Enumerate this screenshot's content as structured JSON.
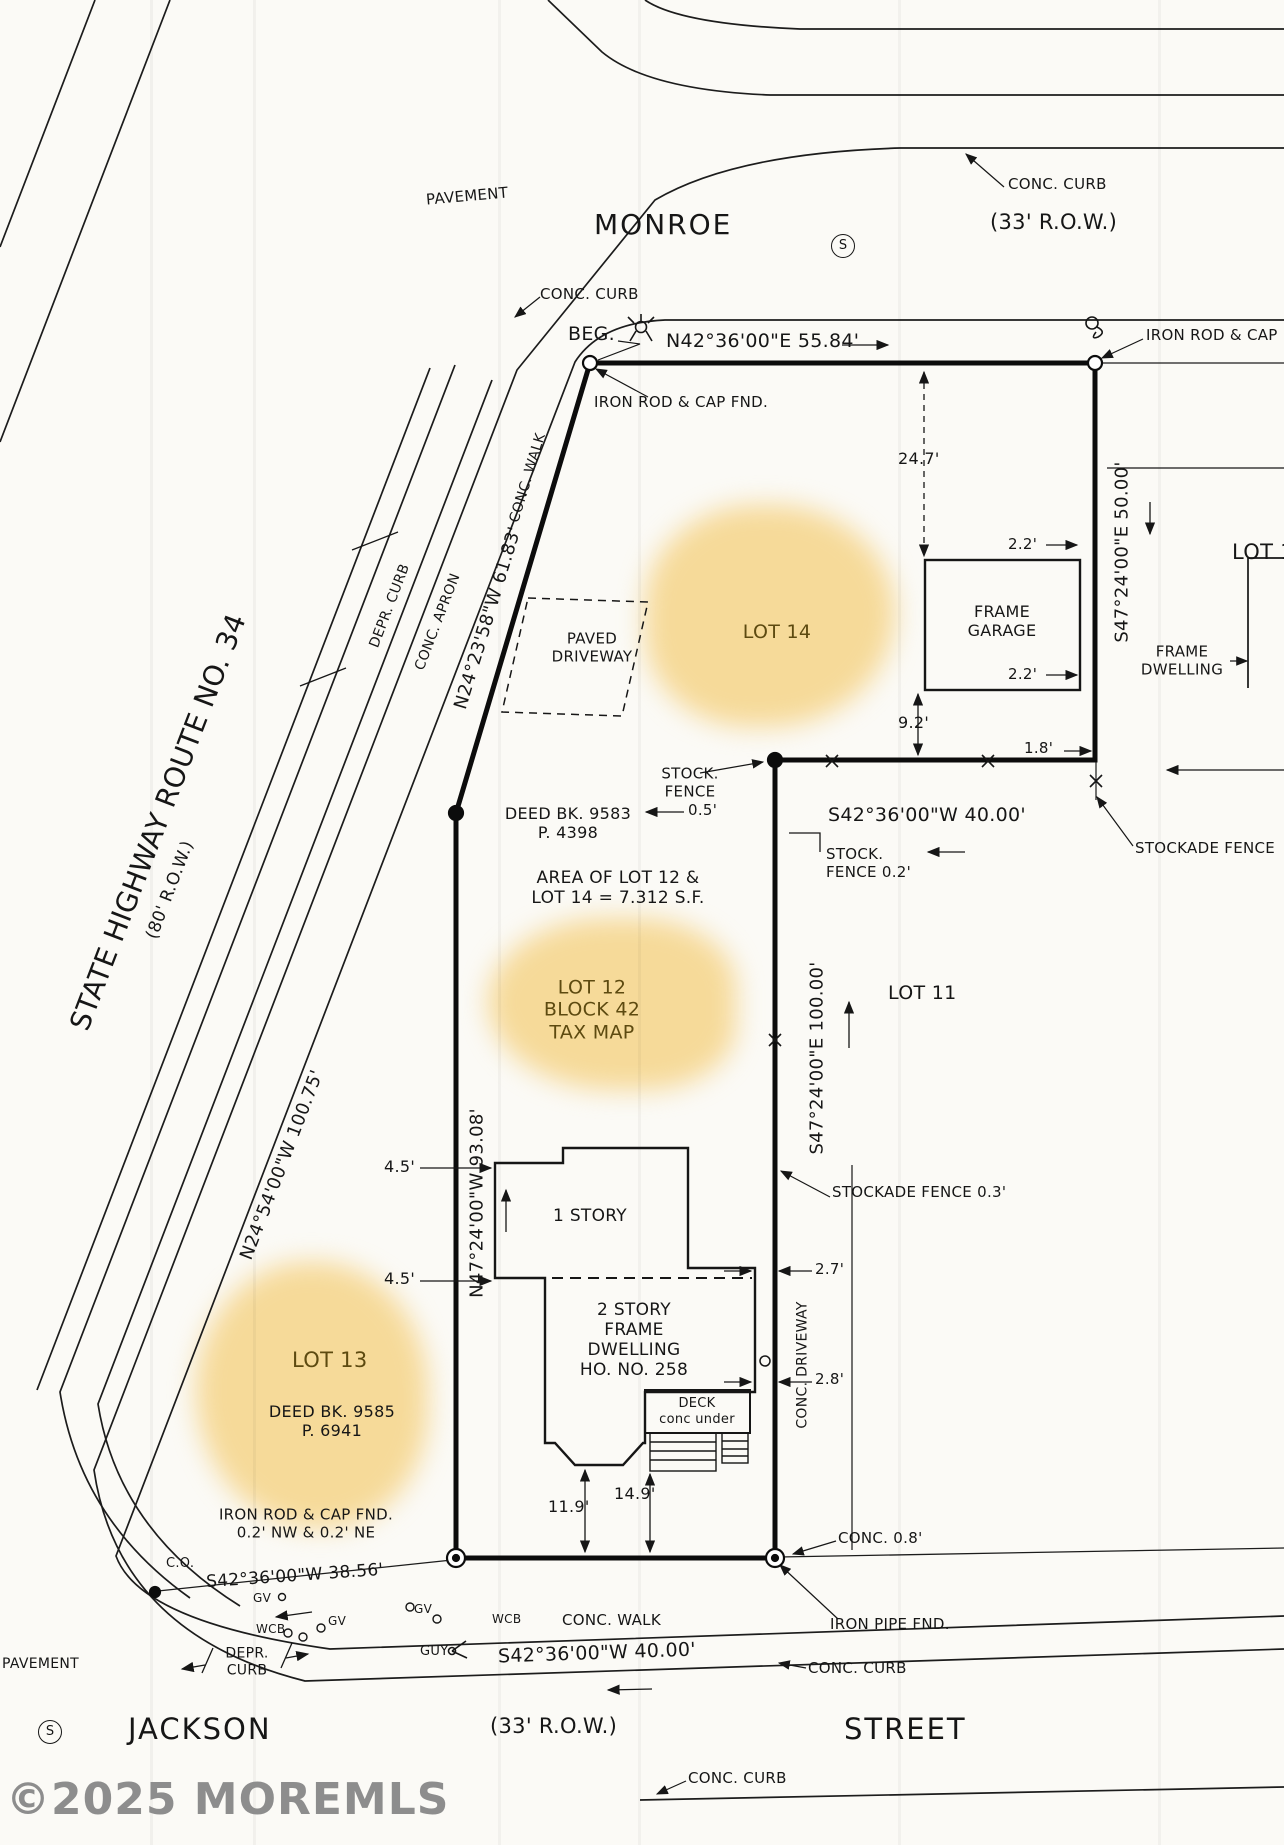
{
  "watermark": "©2025 MOREMLS",
  "streets": {
    "monroe": "MONROE",
    "monroe_row": "(33' R.O.W.)",
    "jackson": "JACKSON",
    "jackson_row": "(33' R.O.W.)",
    "street": "STREET",
    "highway_name": "STATE  HIGHWAY  ROUTE  NO. 34",
    "highway_row": "(80' R.O.W.)",
    "pavement_top": "PAVEMENT",
    "pavement_bottom": "PAVEMENT",
    "s_symbol": "S"
  },
  "bearings": {
    "top": "N42°36'00\"E  55.84'",
    "right_50": "S47°24'00\"E  50.00'",
    "mid_40": "S42°36'00\"W  40.00'",
    "east_100": "S47°24'00\"E  100.00'",
    "west_93": "N47°24'00\"W  93.08'",
    "nw_61": "N24°23'58\"W  61.83'",
    "nw_100": "N24°54'00\"W  100.75'",
    "south_38": "S42°36'00\"W  38.56'",
    "south_40": "S42°36'00\"W  40.00'"
  },
  "lots": {
    "lot14": "LOT 14",
    "lot12": "LOT 12\nBLOCK 42\nTAX MAP",
    "lot13": "LOT 13",
    "lot11": "LOT 11",
    "lot1": "LOT 1",
    "area_note": "AREA OF LOT 12 &\nLOT 14 = 7.312 S.F.",
    "deed_9583": "DEED BK. 9583\nP. 4398",
    "deed_9585": "DEED BK. 9585\nP. 6941"
  },
  "buildings": {
    "garage": "FRAME\nGARAGE",
    "dwelling": "2 STORY\nFRAME\nDWELLING\nHO. NO. 258",
    "one_story": "1 STORY",
    "deck": "DECK\nconc under",
    "neighbor_dwelling": "FRAME\nDWELLING",
    "paved_driveway": "PAVED\nDRIVEWAY",
    "conc_driveway": "CONC. DRIVEWAY"
  },
  "monuments": {
    "beg": "BEG.",
    "iron_rod_cap_fnd": "IRON ROD & CAP FND.",
    "iron_rod_cap_right": "IRON ROD & CAP",
    "iron_rod_nw": "IRON ROD & CAP FND.\n0.2' NW & 0.2' NE",
    "iron_pipe": "IRON PIPE FND.",
    "co": "C.O."
  },
  "site_notes": {
    "conc_curb_top1": "CONC. CURB",
    "conc_curb_top2": "CONC. CURB",
    "conc_curb_bottom1": "CONC. CURB",
    "conc_curb_bottom2": "CONC. CURB",
    "conc_walk_hwy": "CONC. WALK",
    "conc_walk_bottom": "CONC. WALK",
    "conc_apron": "CONC. APRON",
    "depr_curb_hwy": "DEPR. CURB",
    "depr_curb_bottom": "DEPR.\nCURB",
    "stock_fence_left": "STOCK.\nFENCE",
    "stock_fence_05": "0.5'",
    "stock_fence_02": "STOCK.\nFENCE 0.2'",
    "stockade_fence_right": "STOCKADE FENCE",
    "stockade_fence_03": "STOCKADE FENCE 0.3'",
    "conc_08": "CONC. 0.8'",
    "gv1": "GV",
    "gv2": "GV",
    "gv3": "GV",
    "wcb1": "WCB",
    "wcb2": "WCB",
    "guy": "GUY"
  },
  "dims": {
    "d24_7": "24.7'",
    "d2_2_top": "2.2'",
    "d2_2_bot": "2.2'",
    "d9_2": "9.2'",
    "d1_8": "1.8'",
    "d4_5_a": "4.5'",
    "d4_5_b": "4.5'",
    "d2_7": "2.7'",
    "d2_8": "2.8'",
    "d11_9": "11.9'",
    "d14_9": "14.9'"
  }
}
